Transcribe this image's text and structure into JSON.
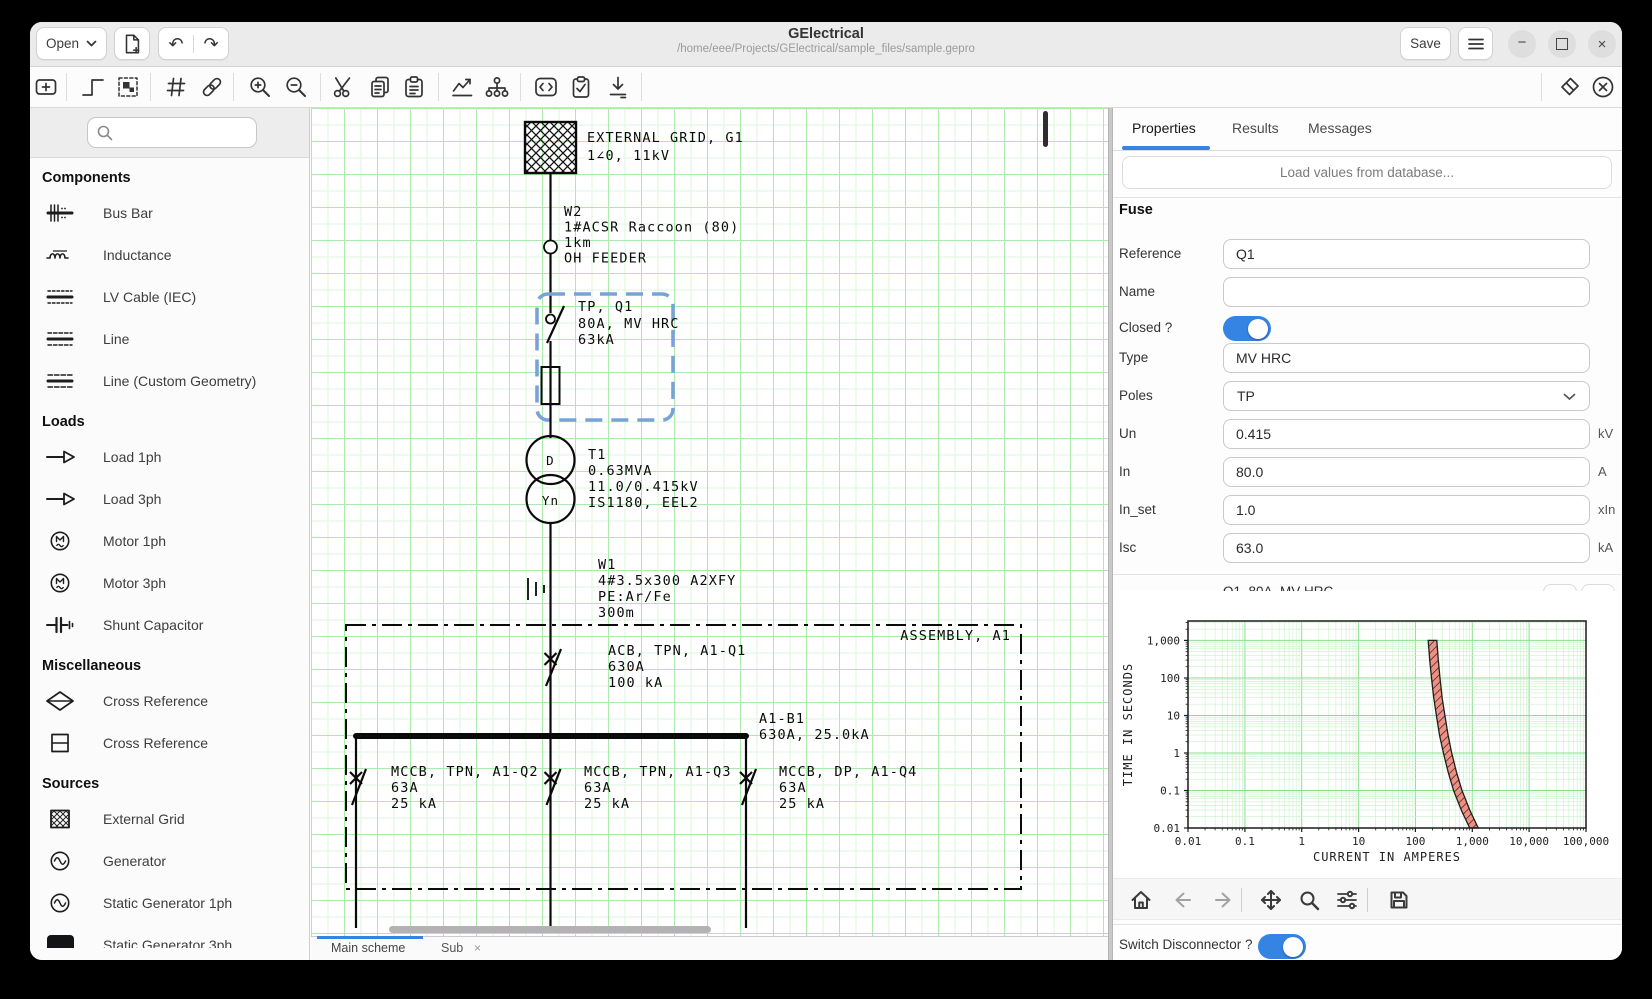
{
  "window": {
    "title": "GElectrical",
    "subtitle": "/home/eee/Projects/GElectrical/sample_files/sample.gepro",
    "open_button": "Open",
    "save_button": "Save"
  },
  "toolbar": {
    "icons": [
      "add-component",
      "draw-wire",
      "insert-assembly",
      "element-reference",
      "link-elements",
      "zoom-in",
      "zoom-out",
      "cut",
      "copy",
      "paste",
      "run-analysis",
      "network-model",
      "edit-code",
      "rules-check",
      "import-values",
      "eraser",
      "delete-element"
    ]
  },
  "sidebar": {
    "search_placeholder": "",
    "sections": [
      {
        "title": "Components",
        "items": [
          "Bus Bar",
          "Inductance",
          "LV Cable (IEC)",
          "Line",
          "Line (Custom Geometry)"
        ]
      },
      {
        "title": "Loads",
        "items": [
          "Load 1ph",
          "Load 3ph",
          "Motor 1ph",
          "Motor 3ph",
          "Shunt Capacitor"
        ]
      },
      {
        "title": "Miscellaneous",
        "items": [
          "Cross Reference",
          "Cross Reference"
        ]
      },
      {
        "title": "Sources",
        "items": [
          "External Grid",
          "Generator",
          "Static Generator 1ph",
          "Static Generator 3ph"
        ]
      }
    ]
  },
  "canvas": {
    "sheet_tabs": [
      {
        "label": "Main scheme",
        "active": true
      },
      {
        "label": "Sub",
        "close": "×",
        "active": false
      }
    ],
    "schematic": {
      "external_grid": [
        "EXTERNAL GRID, G1",
        "1∠0, 11kV"
      ],
      "w2": [
        "W2",
        "1#ACSR Raccoon (80)",
        "1km",
        "OH FEEDER"
      ],
      "q1": [
        "TP, Q1",
        "80A, MV HRC",
        "63kA"
      ],
      "t1": [
        "T1",
        "0.63MVA",
        "11.0/0.415kV",
        "IS1180, EEL2"
      ],
      "t1_hv": "D",
      "t1_lv": "Yn",
      "w1": [
        "W1",
        "4#3.5x300 A2XFY",
        "PE:Ar/Fe",
        "300m"
      ],
      "assembly": "ASSEMBLY, A1",
      "acb": [
        "ACB, TPN, A1-Q1",
        "630A",
        "100 kA"
      ],
      "busbar": [
        "A1-B1",
        "630A, 25.0kA"
      ],
      "q2": [
        "MCCB, TPN, A1-Q2",
        "63A",
        "25 kA"
      ],
      "q3": [
        "MCCB, TPN, A1-Q3",
        "63A",
        "25 kA"
      ],
      "q4": [
        "MCCB, DP, A1-Q4",
        "63A",
        "25 kA"
      ]
    }
  },
  "panel": {
    "tabs": [
      {
        "label": "Properties",
        "active": true
      },
      {
        "label": "Results",
        "active": false
      },
      {
        "label": "Messages",
        "active": false
      }
    ],
    "load_button": "Load values from database...",
    "section": "Fuse",
    "fields": [
      {
        "label": "Reference",
        "value": "Q1",
        "unit": ""
      },
      {
        "label": "Name",
        "value": "",
        "unit": ""
      },
      {
        "label": "Closed ?",
        "value": "on",
        "unit": ""
      },
      {
        "label": "Type",
        "value": "MV HRC",
        "unit": ""
      },
      {
        "label": "Poles",
        "value": "TP",
        "unit": ""
      },
      {
        "label": "Un",
        "value": "0.415",
        "unit": "kV"
      },
      {
        "label": "In",
        "value": "80.0",
        "unit": "A"
      },
      {
        "label": "In_set",
        "value": "1.0",
        "unit": "xIn"
      },
      {
        "label": "Isc",
        "value": "63.0",
        "unit": "kA"
      }
    ],
    "line_protection": {
      "label": "Line Protection",
      "value": "Q1, 80A, MV HRC"
    },
    "switch_disconnector": {
      "label": "Switch Disconnector ?",
      "value": "on"
    }
  },
  "chart_data": {
    "type": "area",
    "title": "",
    "xlabel": "CURRENT IN AMPERES",
    "ylabel": "TIME IN SECONDS",
    "xscale": "log",
    "yscale": "log",
    "xlim": [
      0.01,
      100000
    ],
    "ylim": [
      0.01,
      3300
    ],
    "xtick_values": [
      0.01,
      0.1,
      1,
      10,
      100,
      1000,
      10000,
      100000
    ],
    "xtick_labels": [
      "0.01",
      "0.1",
      "1",
      "10",
      "100",
      "1,000",
      "10,000",
      "100,000"
    ],
    "ytick_values": [
      0.01,
      0.1,
      1,
      10,
      100,
      1000
    ],
    "ytick_labels": [
      "0.01",
      "0.1",
      "1",
      "10",
      "100",
      "1,000"
    ],
    "grid": true,
    "grid_color_major": "#8fdc8f",
    "grid_color_minor": "#c9f0c9",
    "legend": false,
    "series": [
      {
        "name": "Q1, 80A, MV HRC damage band",
        "kind": "band",
        "t": [
          1000,
          300,
          100,
          30,
          10,
          3,
          1,
          0.3,
          0.1,
          0.03,
          0.01
        ],
        "i_min": [
          168,
          178,
          192,
          210,
          234,
          265,
          310,
          378,
          470,
          640,
          900
        ],
        "i_max": [
          238,
          252,
          270,
          295,
          330,
          375,
          435,
          530,
          660,
          905,
          1270
        ],
        "fill": "#ee9184",
        "hatch": "diagonal",
        "edge": "#1f1f1f"
      }
    ]
  }
}
